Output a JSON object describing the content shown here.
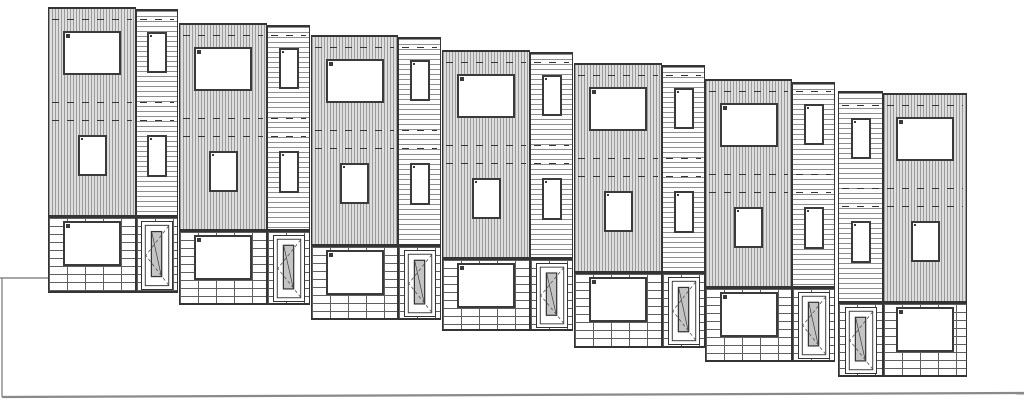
{
  "meta": {
    "title": "seven-unit-townhouse-row-street-elevation",
    "drawing_type": "architectural-elevation",
    "canvas": {
      "width": 1024,
      "height": 404
    }
  },
  "colors": {
    "line": "#343434",
    "frame": "#3a3a3a",
    "glass": "#c4c4c4",
    "vfill": "#dedede",
    "vstripe": "#9b9b9b",
    "hfill": "#fdfdfd",
    "hstripe": "#8e8e8e",
    "mortar": "#5f5f5f",
    "ground": "#8a8a8a"
  },
  "elevation": {
    "unit_count": 7,
    "stories": 3,
    "hatch_legend": {
      "main_bay": "vertical-line siding hatch (gray)",
      "entry_bay": "horizontal-line lap siding hatch (white)",
      "base": "brick running-bond hatch (white)"
    },
    "units": [
      {
        "id": 1,
        "main_x": 48,
        "main_w": 88,
        "narrow_x": 136,
        "narrow_w": 42,
        "main_top": 7,
        "narrow_top": 9,
        "brick_top": 216,
        "bottom": 293,
        "entry_side": "right"
      },
      {
        "id": 2,
        "main_x": 179,
        "main_w": 88,
        "narrow_x": 267,
        "narrow_w": 43,
        "main_top": 23,
        "narrow_top": 25,
        "brick_top": 230,
        "bottom": 305,
        "entry_side": "right"
      },
      {
        "id": 3,
        "main_x": 311,
        "main_w": 87,
        "narrow_x": 398,
        "narrow_w": 43,
        "main_top": 35,
        "narrow_top": 37,
        "brick_top": 245,
        "bottom": 320,
        "entry_side": "right"
      },
      {
        "id": 4,
        "main_x": 442,
        "main_w": 88,
        "narrow_x": 530,
        "narrow_w": 43,
        "main_top": 50,
        "narrow_top": 52,
        "brick_top": 258,
        "bottom": 331,
        "entry_side": "right"
      },
      {
        "id": 5,
        "main_x": 574,
        "main_w": 88,
        "narrow_x": 662,
        "narrow_w": 43,
        "main_top": 63,
        "narrow_top": 65,
        "brick_top": 272,
        "bottom": 348,
        "entry_side": "right"
      },
      {
        "id": 6,
        "main_x": 705,
        "main_w": 87,
        "narrow_x": 792,
        "narrow_w": 43,
        "main_top": 79,
        "narrow_top": 82,
        "brick_top": 287,
        "bottom": 362,
        "entry_side": "right"
      },
      {
        "id": 7,
        "main_x": 883,
        "main_w": 84,
        "narrow_x": 838,
        "narrow_w": 45,
        "main_top": 93,
        "narrow_top": 91,
        "brick_top": 302,
        "bottom": 377,
        "entry_side": "left"
      }
    ],
    "unit_features": {
      "triple_window_upper": {
        "dy": 24,
        "w": 58,
        "h": 44,
        "transom_split": 0.46
      },
      "single_window_mid": {
        "dy": 128,
        "w": 29,
        "h": 41,
        "split": 0.46
      },
      "triple_window_ground": {
        "dy_from_brick": 3,
        "w": 58,
        "h": 45,
        "transom_split": 0.55
      },
      "slot_window_upper": {
        "dy": 25,
        "w": 20,
        "h": 41
      },
      "slot_window_mid": {
        "dy": 128,
        "w": 20,
        "h": 42
      },
      "door": {
        "w": 32,
        "top_inset": 5,
        "bottom_inset": 3
      },
      "floor_dash_offsets": [
        10,
        93,
        111
      ]
    },
    "ground": {
      "grade_left": {
        "x1": 0,
        "y1": 278,
        "x2": 48,
        "y2": 278
      },
      "grade_drop": {
        "x1": 2,
        "y1": 278,
        "x2": 2,
        "y2": 397
      },
      "base_line": {
        "x1": 2,
        "y1": 397,
        "x2": 1024,
        "y2": 393
      }
    }
  }
}
